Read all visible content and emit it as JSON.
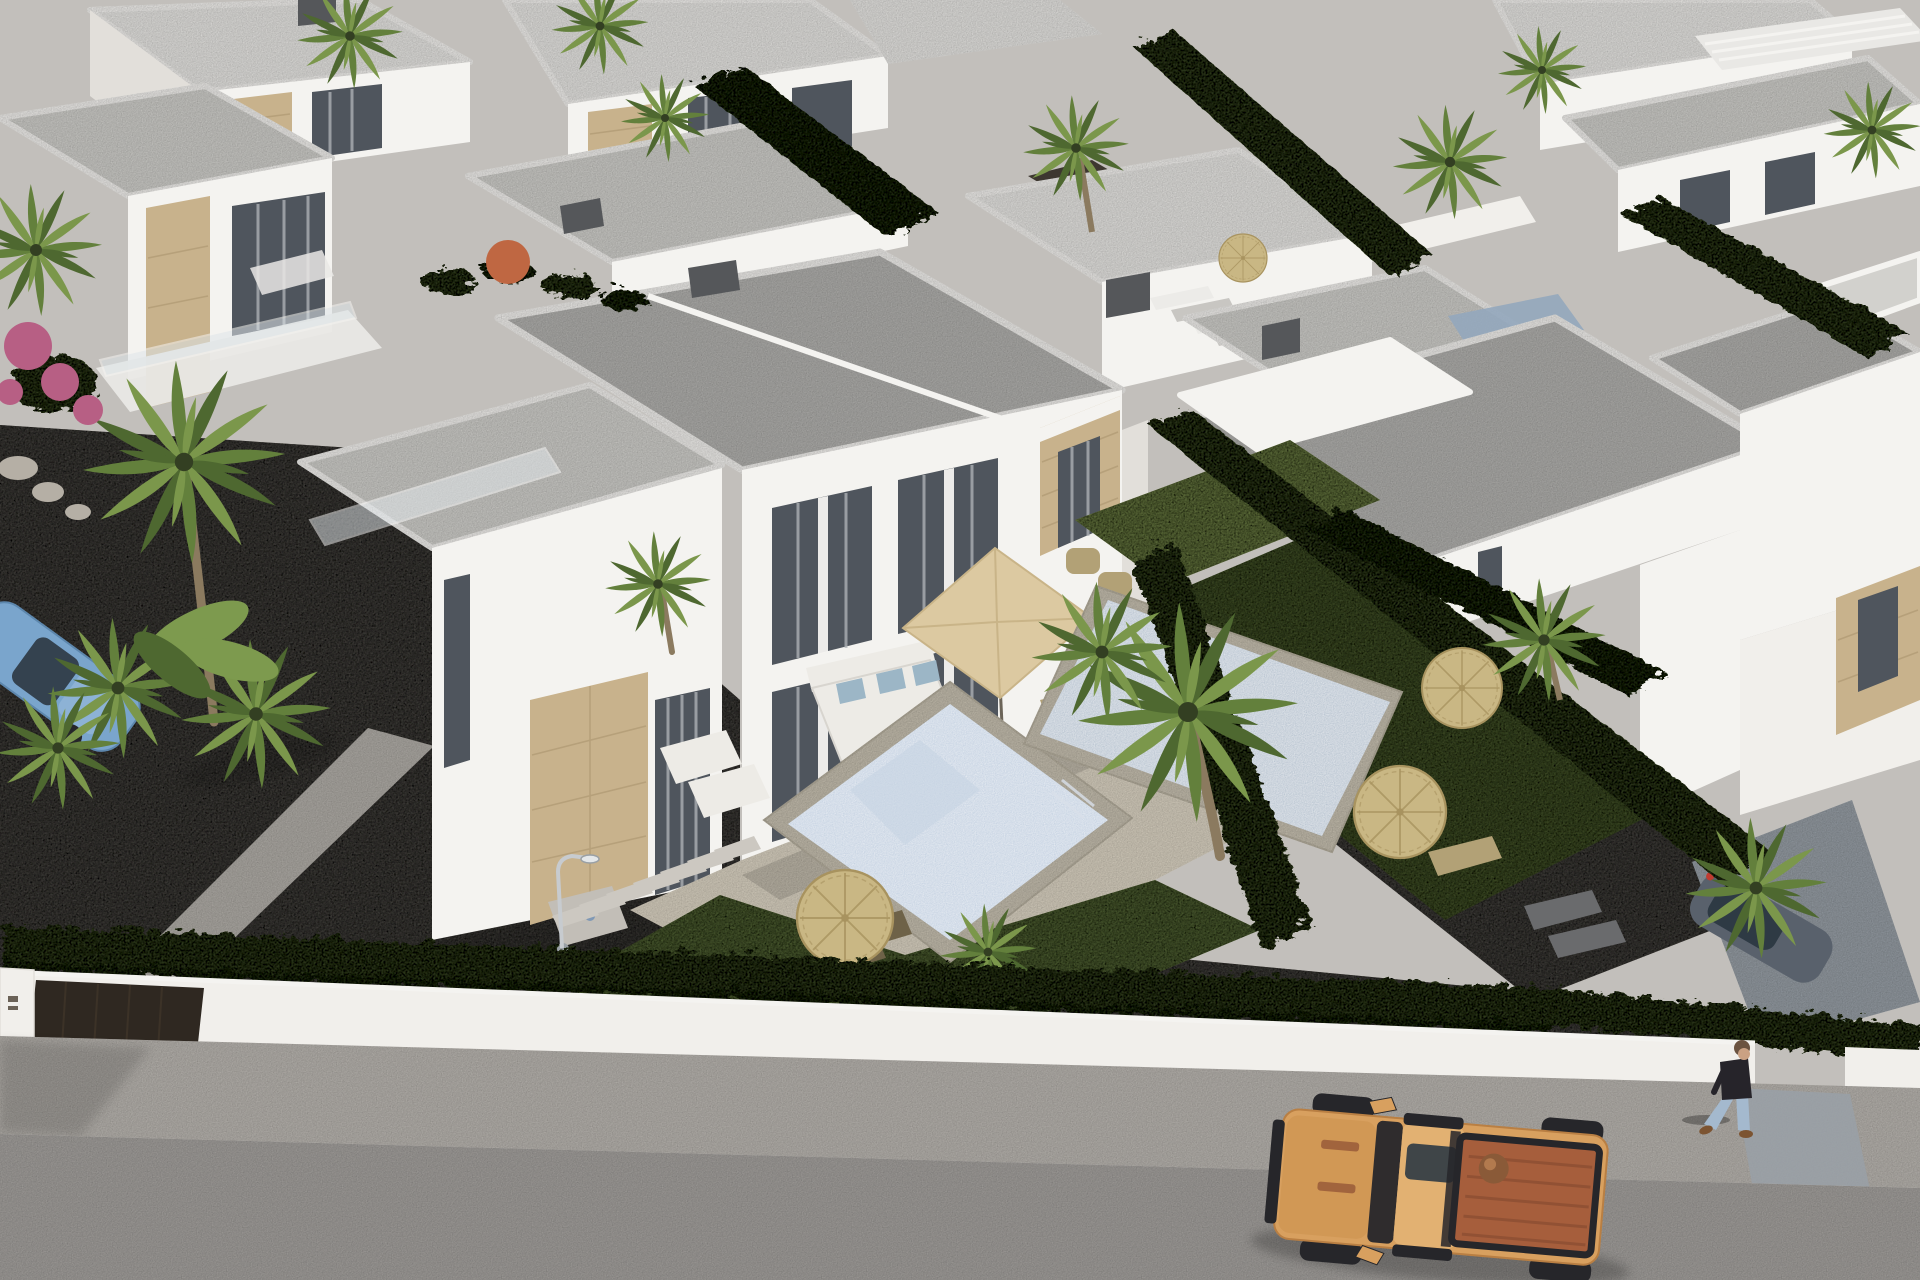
{
  "scene": {
    "type": "aerial-3d-architectural-render",
    "description": "Aerial 3D render of a modern villa development: white flat-roofed semi-detached villas with beige stone cladding, two private mosaic pools, lawns, dark gravel gardens, palm trees and straw parasols, a white perimeter wall with dark gates, a speckled sidewalk and gray street with an orange pickup truck, a light-blue car at the left edge, a parked dark car and a walking pedestrian on the right.",
    "objects": [
      "white-villa",
      "semi-detached-villa",
      "flat-gray-roof",
      "roof-parapet",
      "chimney",
      "stone-cladding",
      "floor-to-ceiling-window",
      "curtains",
      "rooftop-terrace",
      "glass-balustrade",
      "tiled-terrace",
      "outdoor-corner-sofa",
      "blue-cushions",
      "coffee-tables",
      "square-beige-parasol",
      "dining-set",
      "sun-lounger",
      "straw-parasol",
      "private-swimming-pool",
      "pool-coping",
      "lawn",
      "gravel-garden",
      "stepping-stones",
      "garden-floor-lamp",
      "boxwood-hedge",
      "cypress-hedge",
      "palm-tree",
      "banana-plant",
      "bougainvillea",
      "rocks",
      "perimeter-white-wall",
      "driveway-gate",
      "entrance-post",
      "sidewalk",
      "asphalt-street",
      "concrete-driveway",
      "exterior-staircase",
      "orange-pickup-truck",
      "truck-cargo-bed",
      "blue-convertible-car",
      "parked-dark-car",
      "pedestrian",
      "red-car-behind-fence",
      "timber-slat-fence",
      "background-villas"
    ]
  },
  "colors": {
    "backdrop": "#c2bfbb",
    "road": "#a8a5a2",
    "sidewalk": "#bdb9b4",
    "curb": "#d8d5d0",
    "wallWhite": "#f1efeb",
    "white": "#f4f3f0",
    "shade": "#e2dfda",
    "roofGray": "#b4b3b0",
    "roofLight": "#d2d1cd",
    "roofWhite": "#e9e8e5",
    "gate": "#2f2821",
    "gravel": "#4e4b46",
    "pathLight": "#b4b0aa",
    "stone": "#c8b28c",
    "stoneLine": "#a8926c",
    "window": "#4f555d",
    "curtain": "#b2b6ba",
    "chimney": "#55575a",
    "terrace": "#ddd5c5",
    "coping": "#c9c2b2",
    "waterLight": "#a9bed6",
    "waterPale": "#c7d3e3",
    "waterDark": "#93a7bc",
    "grass": "#5c6e3e",
    "grassDark": "#4d5d33",
    "grassLight": "#75874c",
    "hedge": "#44532e",
    "hedgeDark": "#333f22",
    "palm1": "#63803c",
    "palm2": "#4e6830",
    "palm3": "#7b974b",
    "banana": "#7d9a4e",
    "trunk": "#8b7a5f",
    "strawTop": "#c9b784",
    "strawLine": "#a8935f",
    "parasolBeige": "#dcc9a1",
    "parasolOrange": "#bf6742",
    "wood": "#b2a176",
    "woodDark": "#6e6248",
    "sofa": "#edebe6",
    "cushion": "#9cb6c6",
    "lamp": "#c7cbcf",
    "lampDark": "#9aa0a5",
    "drive": "#99a0a7",
    "truckBody": "#d8a05f",
    "truckRoof": "#e2b172",
    "truckBed": "#a65e3c",
    "truckDark": "#26262a",
    "truckTrim": "#8d4f33",
    "carBlue": "#7aa5cc",
    "carDark": "#59616c",
    "glassDark": "#2e3a44",
    "red": "#b23b2e",
    "taillight": "#c23b31",
    "flower": "#b75f84",
    "skin": "#caa183",
    "hair": "#6b5340",
    "shirt": "#26242a",
    "jeans": "#a4b9ce",
    "shoe": "#7c5432",
    "rock": "#b5afa5",
    "stairLight": "#ecebe8",
    "stairDark": "#c8c6c2",
    "slab": "#ccc8c1",
    "pad": "#c2beb7",
    "manhole": "#7f98b5"
  }
}
